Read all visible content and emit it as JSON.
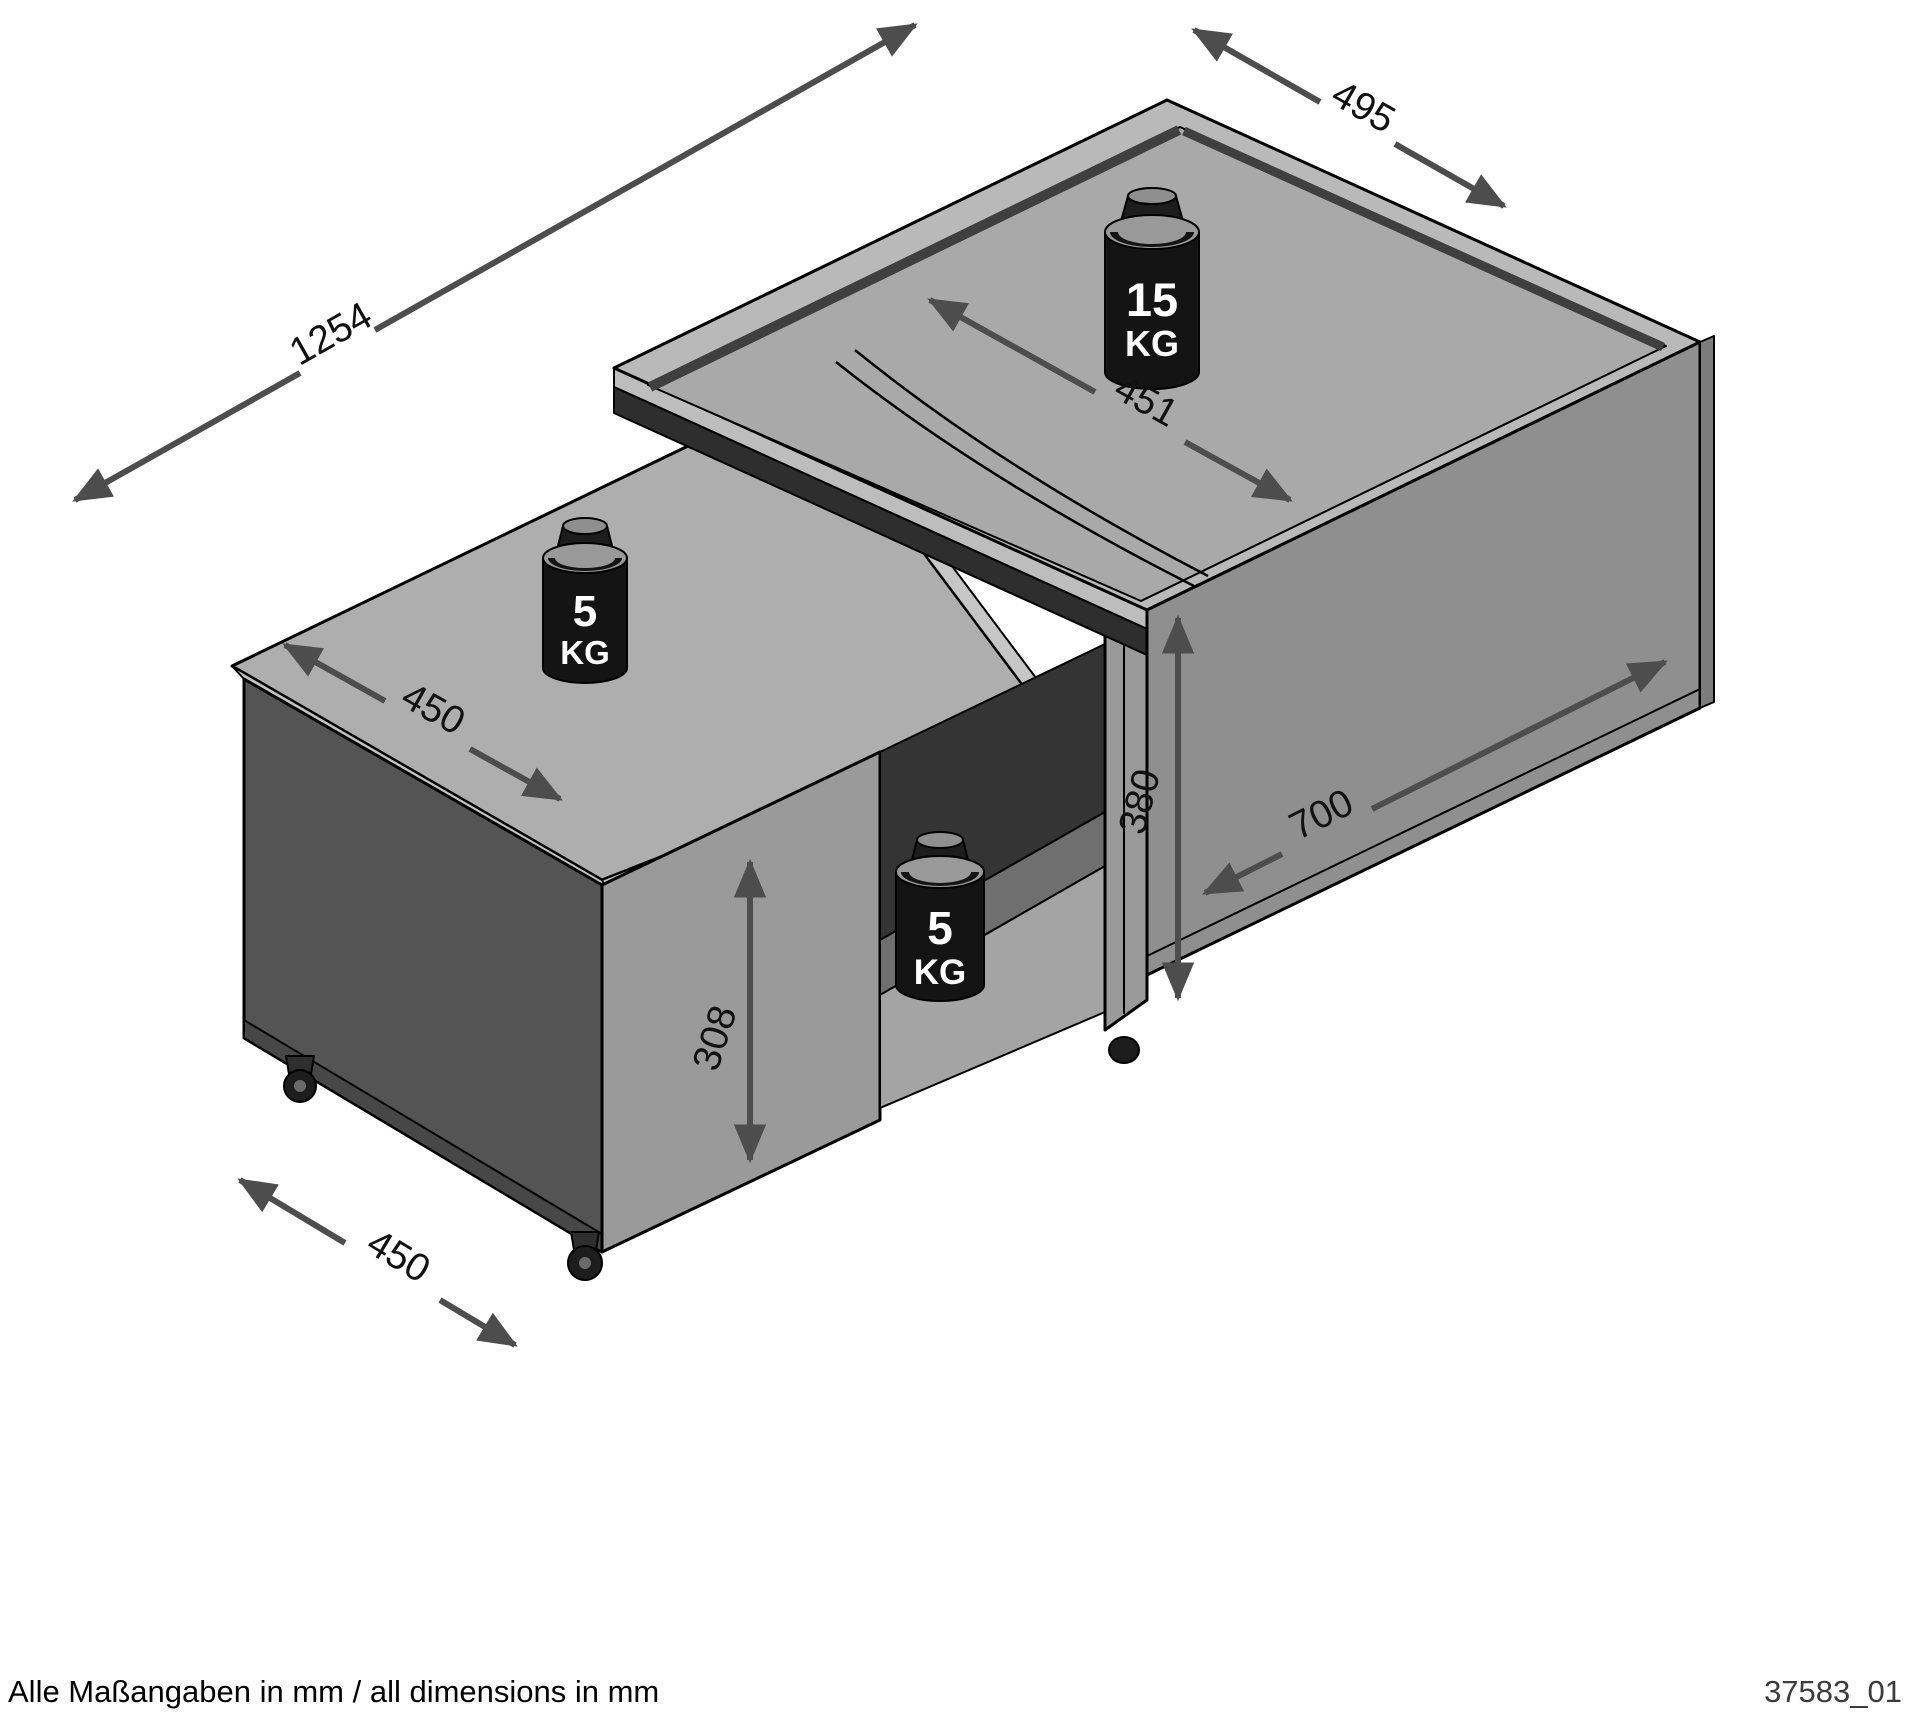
{
  "diagram": {
    "dimensions": {
      "total_length": "1254",
      "total_depth": "495",
      "top_panel_depth": "451",
      "slide_top_depth": "450",
      "main_body_length": "700",
      "main_body_height": "380",
      "slide_body_height": "308",
      "base_depth": "450"
    },
    "weights": {
      "top_max_load": {
        "value": "15",
        "unit": "KG"
      },
      "slide_top_max_load": {
        "value": "5",
        "unit": "KG"
      },
      "shelf_max_load": {
        "value": "5",
        "unit": "KG"
      }
    },
    "footer": {
      "note": "Alle Maßangaben in mm / all dimensions in mm",
      "drawing_number": "37583_01"
    }
  }
}
